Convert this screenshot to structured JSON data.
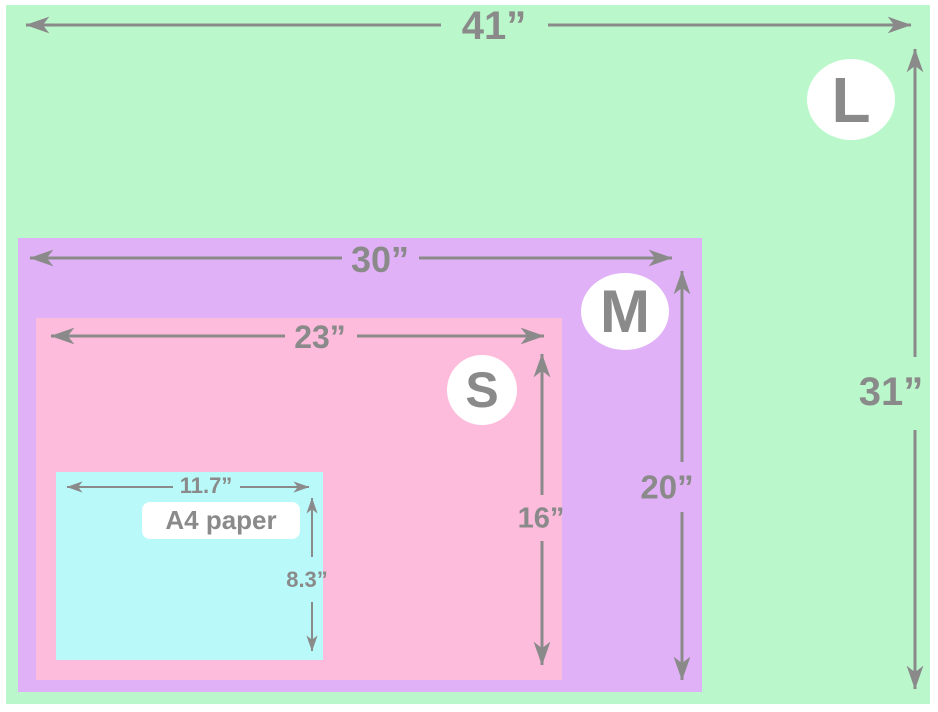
{
  "colors": {
    "large_green": "#baf8cc",
    "medium_purple": "#e0b1f6",
    "small_pink": "#fdbcdc",
    "a4_cyan": "#b9f9f9",
    "line_gray": "#8a8a8a",
    "badge_white": "#ffffff"
  },
  "sizes": {
    "large": {
      "badge": "L",
      "width": "41”",
      "height": "31”"
    },
    "medium": {
      "badge": "M",
      "width": "30”",
      "height": "20”"
    },
    "small": {
      "badge": "S",
      "width": "23”",
      "height": "16”"
    },
    "a4": {
      "label": "A4 paper",
      "width": "11.7”",
      "height": "8.3”"
    }
  }
}
